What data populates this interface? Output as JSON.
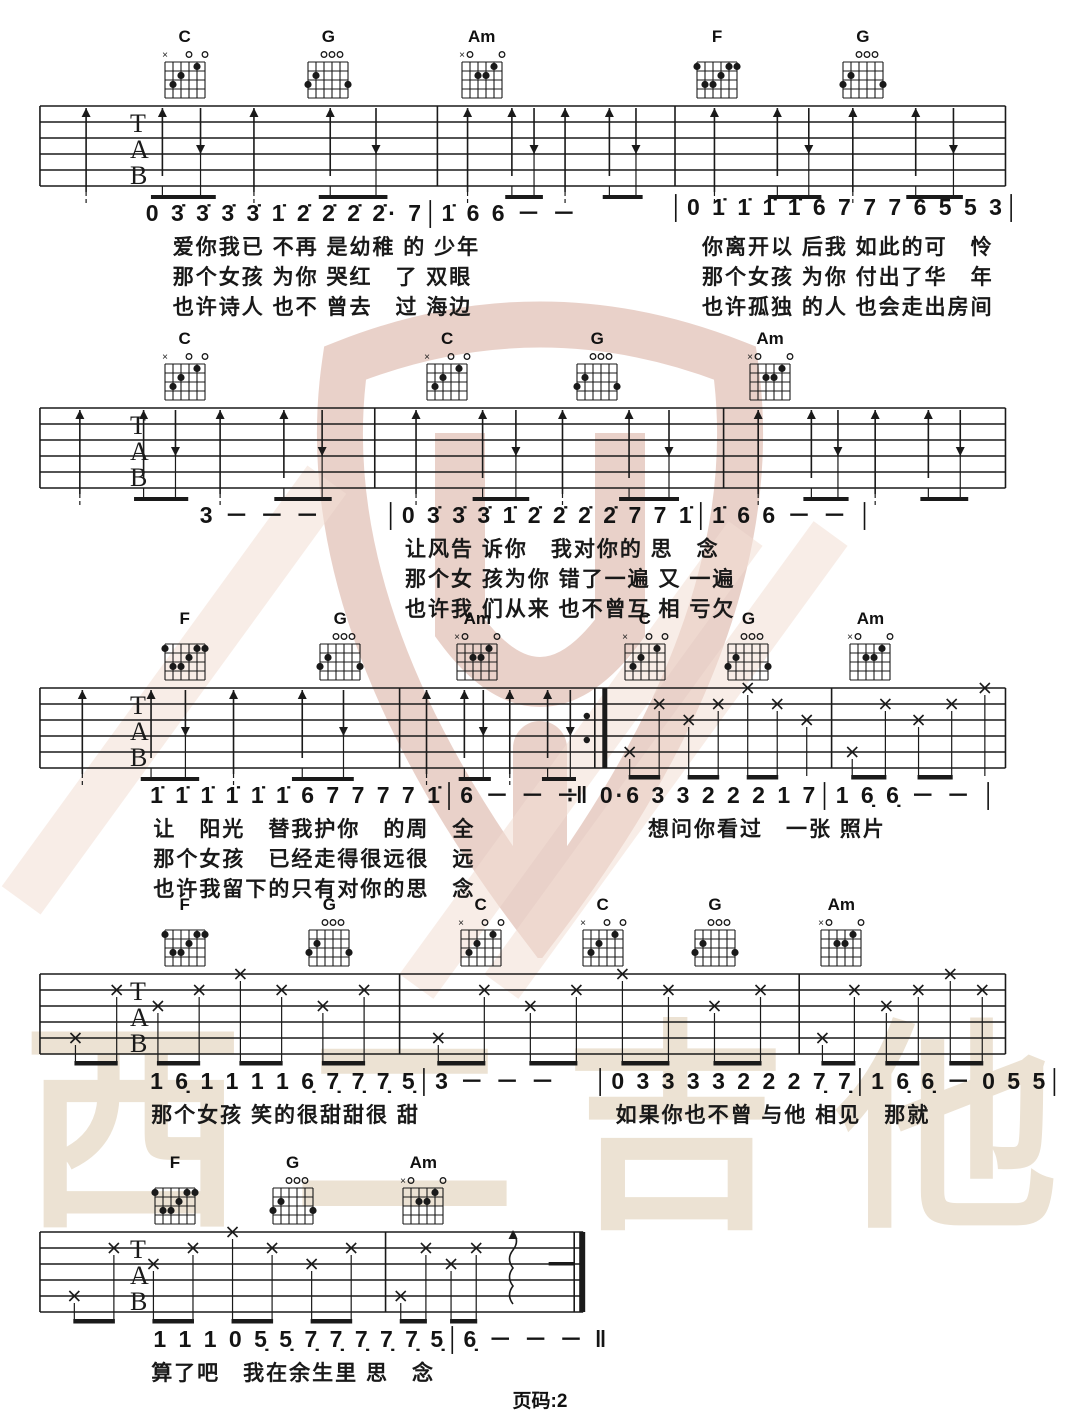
{
  "page": {
    "footer": "页码:2",
    "watermark_text": "西二吉他",
    "colors": {
      "logo": "#cc9280",
      "stripe": "#f3ded4",
      "watermark_text": "#ece2d3",
      "ink": "#1a1a1a"
    }
  },
  "chord_shapes": {
    "C": {
      "muted": [
        6
      ],
      "open": [
        3,
        1
      ],
      "dots": [
        [
          5,
          3
        ],
        [
          4,
          2
        ],
        [
          2,
          1
        ]
      ]
    },
    "G": {
      "muted": [],
      "open": [
        4,
        3,
        2
      ],
      "dots": [
        [
          6,
          3
        ],
        [
          5,
          2
        ],
        [
          1,
          3
        ]
      ]
    },
    "Am": {
      "muted": [
        6
      ],
      "open": [
        5,
        1
      ],
      "dots": [
        [
          4,
          2
        ],
        [
          3,
          2
        ],
        [
          2,
          1
        ]
      ]
    },
    "F": {
      "muted": [],
      "open": [],
      "dots": [
        [
          6,
          1
        ],
        [
          2,
          1
        ],
        [
          1,
          1
        ],
        [
          3,
          2
        ],
        [
          5,
          3
        ],
        [
          4,
          3
        ]
      ]
    }
  },
  "systems": [
    {
      "chords": [
        {
          "name": "C",
          "x": 17.1
        },
        {
          "name": "G",
          "x": 30.4
        },
        {
          "name": "Am",
          "x": 44.6
        },
        {
          "name": "F",
          "x": 66.4
        },
        {
          "name": "G",
          "x": 79.9
        }
      ],
      "staff": {
        "labels": [
          "T",
          "A",
          "B"
        ],
        "start": 3.7,
        "end": 93.1,
        "bars": [
          40.5,
          62.5
        ],
        "segments": [
          {
            "from": 3.7,
            "to": 93.1,
            "pattern": "strum"
          }
        ]
      },
      "melody": [
        {
          "x": 13.5,
          "t": "0 3̇ 3̇ 3̇ 3̇ 1̇ 2̇ 2̇ 2̇ 2̇· 7│1̇ 6 6 － －"
        },
        {
          "x": 62,
          "t": "│0 1̇ 1̇ 1̇ 1̇ 6 7 7 7 6 5 5 3│"
        }
      ],
      "lyrics": [
        {
          "x": 16,
          "lines": [
            "爱你我已 不再 是幼稚 的 少年",
            "那个女孩 为你 哭红　了 双眼",
            "也许诗人 也不 曾去　过 海边"
          ]
        },
        {
          "x": 65,
          "lines": [
            "你离开以 后我 如此的可　怜",
            "那个女孩 为你 付出了华　年",
            "也许孤独 的人 也会走出房间"
          ]
        }
      ]
    },
    {
      "chords": [
        {
          "name": "C",
          "x": 17.1
        },
        {
          "name": "C",
          "x": 41.4
        },
        {
          "name": "G",
          "x": 55.3
        },
        {
          "name": "Am",
          "x": 71.3
        }
      ],
      "staff": {
        "labels": [
          "T",
          "A",
          "B"
        ],
        "start": 3.7,
        "end": 93.1,
        "bars": [
          34.7,
          67
        ],
        "segments": [
          {
            "from": 3.7,
            "to": 93.1,
            "pattern": "strum"
          }
        ]
      },
      "melody": [
        {
          "x": 18.5,
          "t": "3 － － －"
        },
        {
          "x": 35.6,
          "t": "│0 3̇ 3̇ 3̇ 1̇ 2̇ 2̇ 2̇ 2̇ 7 7 1̇│1̇ 6 6 － － │"
        }
      ],
      "lyrics": [
        {
          "x": 37.5,
          "lines": [
            "让风告 诉你　我对你的 思　念",
            "那个女 孩为你 错了一遍 又 一遍",
            "也许我 们从来 也不曾互 相 亏欠"
          ]
        }
      ]
    },
    {
      "chords": [
        {
          "name": "F",
          "x": 17.1
        },
        {
          "name": "G",
          "x": 31.5
        },
        {
          "name": "Am",
          "x": 44.2
        },
        {
          "name": "C",
          "x": 59.7
        },
        {
          "name": "G",
          "x": 69.3
        },
        {
          "name": "Am",
          "x": 80.6
        }
      ],
      "staff": {
        "labels": [
          "T",
          "A",
          "B"
        ],
        "start": 3.7,
        "end": 93.1,
        "bars": [
          37,
          77
        ],
        "repeat_at": 56,
        "segments": [
          {
            "from": 3.7,
            "to": 56,
            "pattern": "strum"
          },
          {
            "from": 56,
            "to": 93.1,
            "pattern": "pick"
          }
        ]
      },
      "melody": [
        {
          "x": 13.9,
          "t": "1̇ 1̇ 1̇ 1̇ 1̇ 1̇ 6 7 7 7 7 1̇│6 － － －"
        },
        {
          "x": 52.5,
          "t": "∶‖ 0·6 3 3 2 2 2 1 7│1 6̣ 6̣ － － │"
        }
      ],
      "lyrics": [
        {
          "x": 14.2,
          "lines": [
            "让　阳光　替我护你　的周　全",
            "那个女孩　已经走得很远很　远",
            "也许我留下的只有对你的思　念"
          ]
        },
        {
          "x": 60,
          "lines": [
            "想问你看过　一张 照片"
          ]
        }
      ]
    },
    {
      "chords": [
        {
          "name": "F",
          "x": 17.1
        },
        {
          "name": "G",
          "x": 30.5
        },
        {
          "name": "C",
          "x": 44.5
        },
        {
          "name": "C",
          "x": 55.8
        },
        {
          "name": "G",
          "x": 66.2
        },
        {
          "name": "Am",
          "x": 77.9
        }
      ],
      "staff": {
        "labels": [
          "T",
          "A",
          "B"
        ],
        "start": 3.7,
        "end": 93.1,
        "bars": [
          37,
          74
        ],
        "segments": [
          {
            "from": 3.7,
            "to": 93.1,
            "pattern": "pick"
          }
        ]
      },
      "melody": [
        {
          "x": 13.9,
          "t": "1 6̣ 1 1 1 1 6̣ 7̣ 7̣ 7̣ 5̣│3 － － －"
        },
        {
          "x": 55,
          "t": "│0 3 3 3 3 2 2 2 7̣ 7̣│1 6̣ 6̣ － 0 5 5│"
        }
      ],
      "lyrics": [
        {
          "x": 14,
          "lines": [
            "那个女孩 笑的很甜甜很 甜"
          ]
        },
        {
          "x": 57,
          "lines": [
            "如果你也不曾 与他 相见　那就"
          ]
        }
      ]
    },
    {
      "chords": [
        {
          "name": "F",
          "x": 16.2
        },
        {
          "name": "G",
          "x": 27.1
        },
        {
          "name": "Am",
          "x": 39.2
        }
      ],
      "staff": {
        "labels": [
          "T",
          "A",
          "B"
        ],
        "start": 3.7,
        "end": 54,
        "bars": [
          35.7
        ],
        "end_style": "final",
        "squiggle_at": 47.5,
        "dash_at": 50.8,
        "segments": [
          {
            "from": 3.7,
            "to": 45.5,
            "pattern": "pick"
          }
        ]
      },
      "melody": [
        {
          "x": 14.2,
          "t": "1 1 1 0 5̣ 5̣ 7̣ 7̣ 7̣ 7̣ 7̣ 5̣│6̣ － － － ‖"
        }
      ],
      "lyrics": [
        {
          "x": 14,
          "lines": [
            "算了吧　我在余生里 思　念"
          ]
        }
      ]
    }
  ]
}
